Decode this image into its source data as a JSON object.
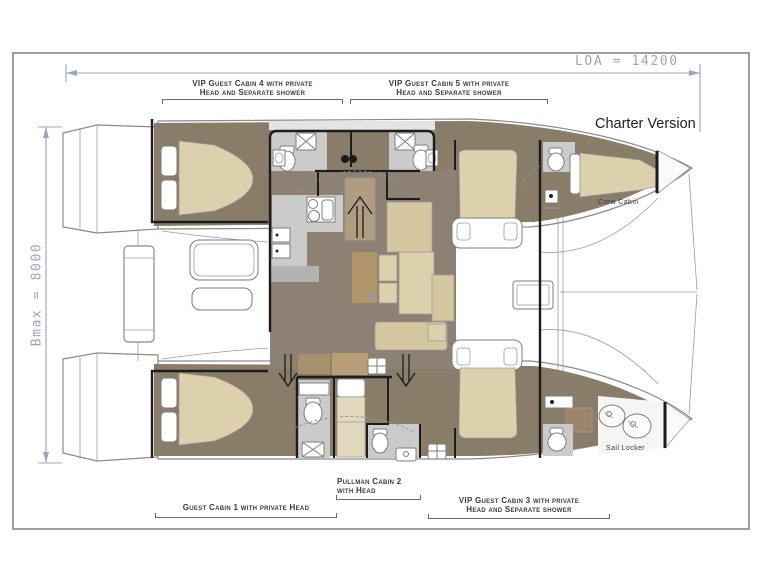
{
  "title": "Charter Version",
  "dimensions": {
    "loa": "LOA = 14200",
    "bmax": "Bmax = 8000"
  },
  "labels": {
    "cabin4": {
      "line1": "VIP Guest Cabin 4 with private",
      "line2": "Head and Separate shower"
    },
    "cabin5": {
      "line1": "VIP Guest Cabin 5 with private",
      "line2": "Head and Separate shower"
    },
    "cabin3": {
      "line1": "VIP Guest Cabin 3 with private",
      "line2": "Head and Separate shower"
    },
    "cabin1": {
      "line1": "Guest Cabin 1 with private Head"
    },
    "cabin2": {
      "line1": "Pullman Cabin 2",
      "line2": "with Head"
    },
    "crew_cabin": "Crew Cabin",
    "sail_locker": "Sail Locker"
  },
  "colors": {
    "dimension": "#a0a3bd",
    "label_text": "#3a3a3a",
    "bulkhead": "#1c1c1c",
    "hull_line": "#8a8a8a",
    "floor_dark": "#897c69",
    "floor_salon": "#8d8173",
    "wet_gray": "#cbcbca",
    "bed_tan": "#ddd1ad",
    "seat_tan": "#d5c8a1",
    "table_brown": "#b2966b"
  }
}
